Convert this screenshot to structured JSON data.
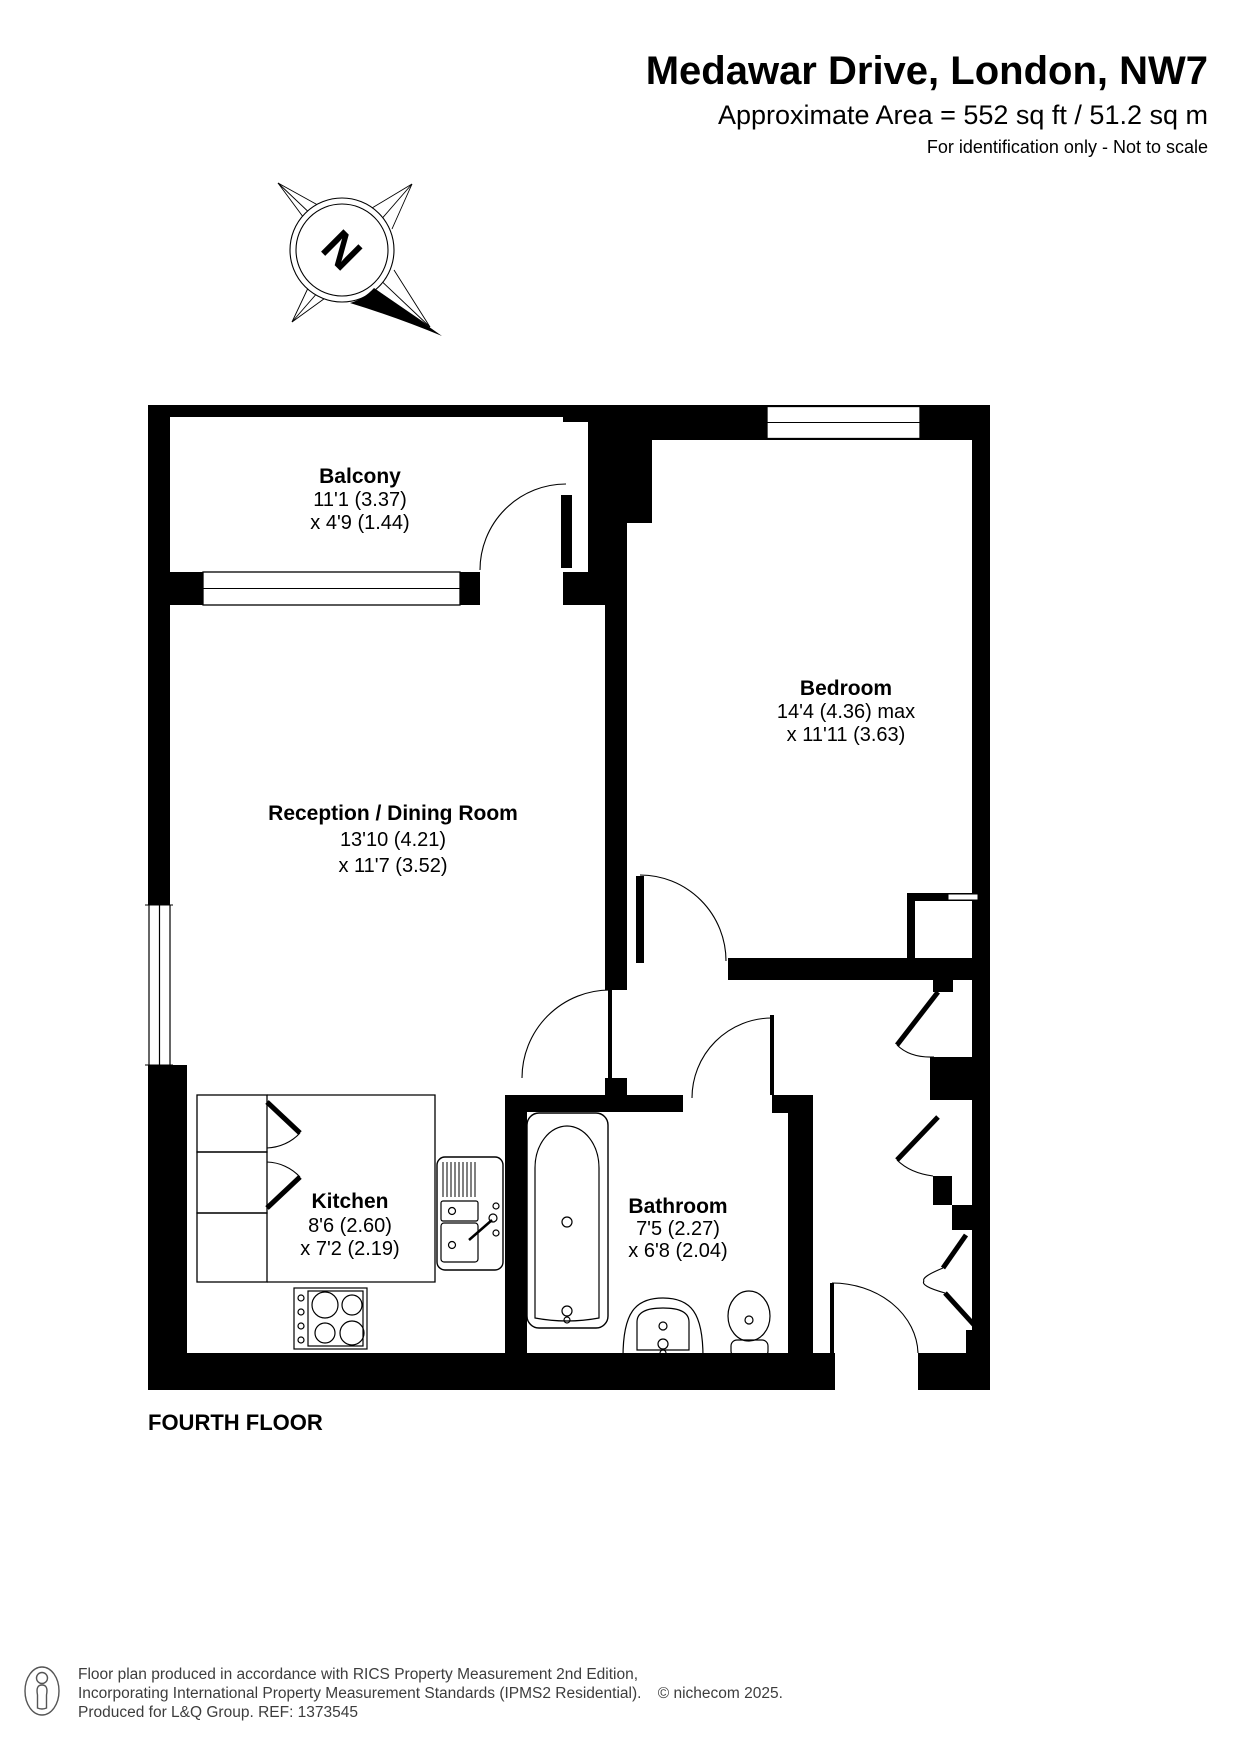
{
  "header": {
    "title": "Medawar Drive, London, NW7",
    "area": "Approximate Area = 552 sq ft / 51.2 sq m",
    "note": "For identification only - Not to scale"
  },
  "compass": {
    "label": "N"
  },
  "plan": {
    "floor_label": "FOURTH FLOOR",
    "rooms": {
      "balcony": {
        "name": "Balcony",
        "dim1": "11'1 (3.37)",
        "dim2": "x 4'9 (1.44)"
      },
      "bedroom": {
        "name": "Bedroom",
        "dim1": "14'4 (4.36) max",
        "dim2": "x 11'11 (3.63)"
      },
      "reception": {
        "name": "Reception / Dining Room",
        "dim1": "13'10 (4.21)",
        "dim2": "x 11'7 (3.52)"
      },
      "kitchen": {
        "name": "Kitchen",
        "dim1": "8'6 (2.60)",
        "dim2": "x 7'2 (2.19)"
      },
      "bathroom": {
        "name": "Bathroom",
        "dim1": "7'5 (2.27)",
        "dim2": "x 6'8 (2.04)"
      }
    }
  },
  "footer": {
    "line1": "Floor plan produced in accordance with RICS Property Measurement 2nd Edition,",
    "line2": "Incorporating International Property Measurement Standards (IPMS2 Residential).",
    "copyright": "© nichecom 2025.",
    "line3": "Produced for L&Q Group.   REF:  1373545"
  },
  "colors": {
    "wall": "#000000",
    "background": "#ffffff",
    "footer_text": "#3d3d3d"
  }
}
